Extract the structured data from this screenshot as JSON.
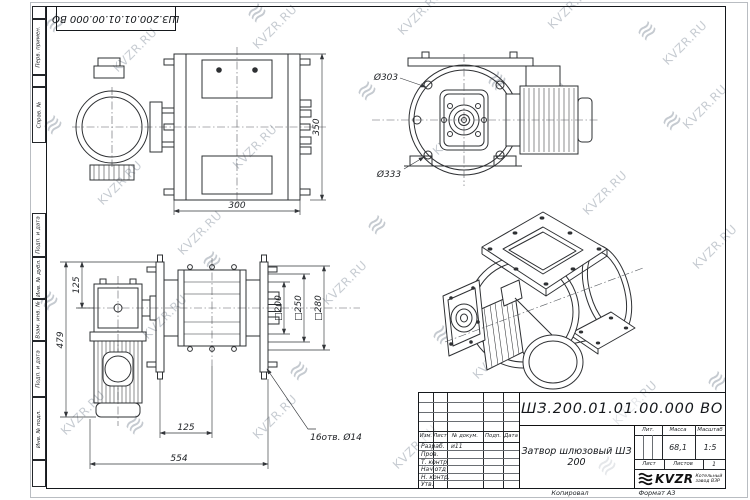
{
  "frame": {
    "top_stamp": "ШЗ.200.01.01.00.000 ВО",
    "margin_labels": [
      "Перв. примен.",
      "Справ. №",
      "Подп. и дата",
      "Инв. № дубл.",
      "Взам. инв. №",
      "Подп. и дата",
      "Инв. № подл."
    ],
    "copied": "Копировал",
    "format": "Формат А3"
  },
  "watermark": {
    "text": "KVZR.RU",
    "logo_glyph": "≋"
  },
  "drawing": {
    "side_view": {
      "dim_width": "300",
      "dim_height": "350"
    },
    "end_view": {
      "inner_dia": "Ø303",
      "outer_dia": "Ø333"
    },
    "front_view": {
      "dim_gear": "125",
      "dim_height": "479",
      "dim_offset": "125",
      "dim_width": "554",
      "dim_opening": "□200",
      "dim_bolts": "□250",
      "dim_flange": "□280",
      "holes_note": "16отв. Ø14"
    }
  },
  "title_block": {
    "doc_number": "ШЗ.200.01.01.00.000 ВО",
    "product_title": "Затвор шлюзовый ШЗ 200",
    "cols": {
      "izm": "Изм.",
      "list": "Лист",
      "doc": "№ докум.",
      "sign": "Подп.",
      "date": "Дата"
    },
    "rows": [
      {
        "label": "Разраб.",
        "doc": "и11"
      },
      {
        "label": "Пров.",
        "doc": ""
      },
      {
        "label": "Т. контр.",
        "doc": ""
      },
      {
        "label": "Нач.отд",
        "doc": ""
      },
      {
        "label": "Н. контр.",
        "doc": ""
      },
      {
        "label": "Утв.",
        "doc": ""
      }
    ],
    "lit_label": "Лит.",
    "mass_label": "Масса",
    "scale_label": "Масштаб",
    "mass_value": "68,1",
    "scale_value": "1:5",
    "sheet_label": "Лист",
    "sheets_label": "Листов",
    "sheets_value": "1",
    "brand": "KVZR",
    "brand_sub1": "Котельный",
    "brand_sub2": "завод ВЗР"
  }
}
